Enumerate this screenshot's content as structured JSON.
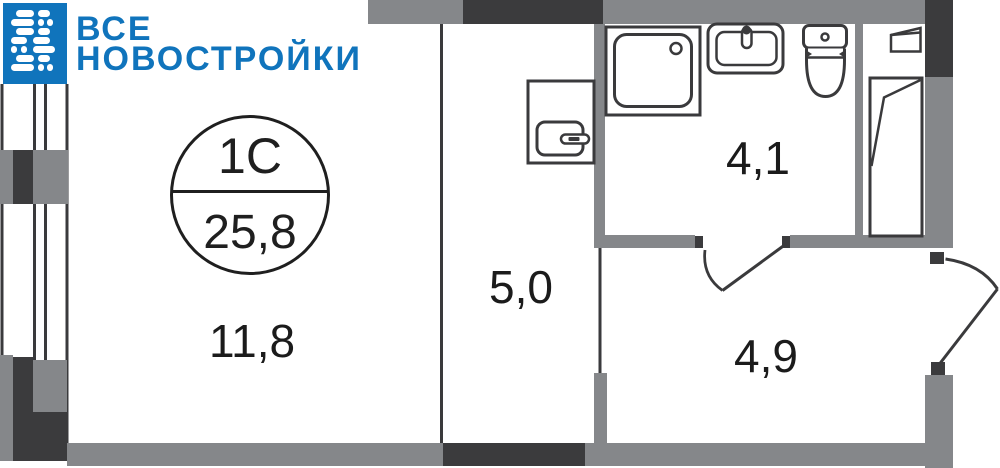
{
  "brand": {
    "line1": "ВСЕ",
    "line2": "НОВОСТРОЙКИ",
    "color": "#1074BC",
    "icon": "building-logo-icon"
  },
  "apartment": {
    "type_badge": "1С",
    "total_area": "25,8"
  },
  "rooms": [
    {
      "id": "living-room",
      "area_label": "11,8"
    },
    {
      "id": "hallway",
      "area_label": "5,0"
    },
    {
      "id": "bathroom",
      "area_label": "4,1"
    },
    {
      "id": "entry-hall",
      "area_label": "4,9"
    }
  ],
  "fixtures": [
    "shower-tray-icon",
    "washbasin-icon",
    "toilet-icon",
    "sink-cabinet-icon",
    "wardrobe-doors-icon",
    "entrance-door-swing-icon",
    "room-door-swing-icon",
    "window-wall-icon"
  ],
  "colors": {
    "wall_gray": "#85878A",
    "wall_dark": "#3B3B3D",
    "line": "#3A3A3C",
    "text": "#1B1B1B",
    "brand_blue": "#1074BC"
  }
}
